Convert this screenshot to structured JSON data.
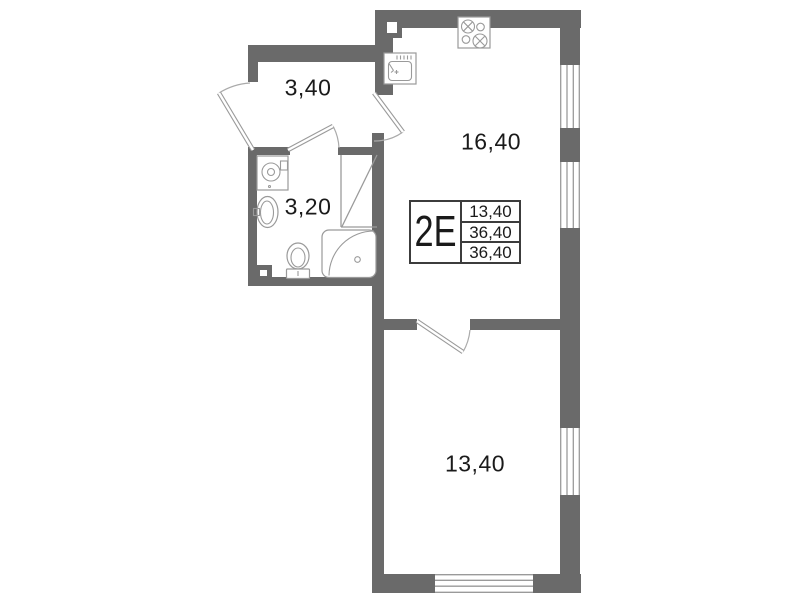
{
  "colors": {
    "wall": "#6a6a6a",
    "line": "#9a9a9a",
    "arc": "#aaaaaa",
    "text": "#1a1a1a",
    "card-border": "#3c3c3c",
    "bg": "#ffffff"
  },
  "rooms": [
    {
      "name": "hallway",
      "area": "3,40"
    },
    {
      "name": "bathroom",
      "area": "3,20"
    },
    {
      "name": "kitchen-living",
      "area": "16,40"
    },
    {
      "name": "bedroom",
      "area": "13,40"
    }
  ],
  "unit_card": {
    "type": "2Е",
    "rows": [
      "13,40",
      "36,40",
      "36,40"
    ]
  },
  "fixtures": [
    "stove",
    "kitchen-sink",
    "ventilation-shaft-kitchen",
    "washing-machine",
    "wash-basin",
    "toilet",
    "corner-bathtub",
    "ventilation-shaft-bathroom"
  ],
  "windows": [
    "kitchen-window-1",
    "kitchen-window-2",
    "bedroom-window-right",
    "bedroom-window-bottom"
  ],
  "doors": [
    "entrance-door",
    "bathroom-door",
    "kitchen-door",
    "bedroom-door"
  ]
}
